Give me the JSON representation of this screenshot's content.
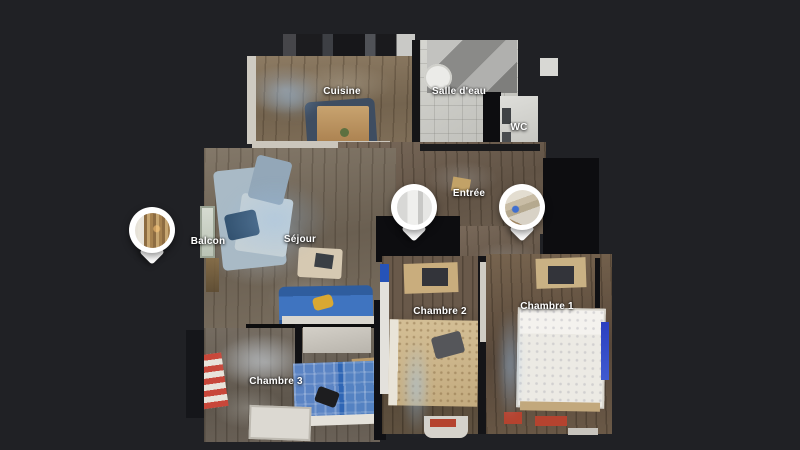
{
  "viewer": {
    "name": "3D floor plan viewer",
    "view_mode": "floorplan",
    "background_color": "#202125"
  },
  "room_labels": [
    {
      "id": "cuisine",
      "label": "Cuisine"
    },
    {
      "id": "salle-deau",
      "label": "Salle d'eau"
    },
    {
      "id": "wc",
      "label": "WC"
    },
    {
      "id": "entree",
      "label": "Entrée"
    },
    {
      "id": "balcon",
      "label": "Balcon"
    },
    {
      "id": "sejour",
      "label": "Séjour"
    },
    {
      "id": "chambre-2",
      "label": "Chambre 2"
    },
    {
      "id": "chambre-1",
      "label": "Chambre 1"
    },
    {
      "id": "chambre-3",
      "label": "Chambre 3"
    }
  ],
  "pins": [
    {
      "id": "pin-balcon",
      "thumbnail": "balcony-wood-shutter-photo"
    },
    {
      "id": "pin-entree",
      "thumbnail": "white-hallway-photo"
    },
    {
      "id": "pin-chambre",
      "thumbnail": "bedroom-wood-beams-photo"
    }
  ],
  "colors": {
    "background": "#202125",
    "pin_ring": "#ffffff",
    "label_text": "#ffffff",
    "sofa_blue": "#3f74c0",
    "bed_blue": "#3e6cac",
    "radiator_red": "#b5432f"
  }
}
